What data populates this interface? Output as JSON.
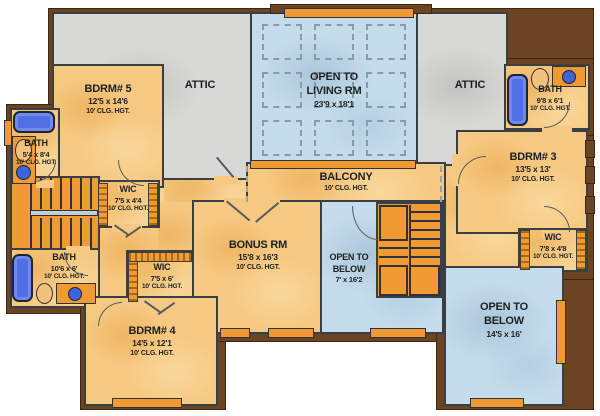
{
  "colors": {
    "interior_wall": "#3a3f44",
    "exterior_wall_brown": "#6b4423",
    "room_tan": "#f6c982",
    "attic_gray": "#d8d8d6",
    "open_area_blue": "#c4dceb",
    "stair_orange": "#ef9a33",
    "fixture_blue": "#4f6fe3",
    "label_text": "#1d2023"
  },
  "rooms": {
    "attic_left": {
      "name": "ATTIC"
    },
    "attic_right": {
      "name": "ATTIC"
    },
    "open_living": {
      "name1": "OPEN TO",
      "name2": "LIVING RM",
      "dims": "23'9 x 18'1"
    },
    "bdrm5": {
      "name": "BDRM# 5",
      "dims": "12'5 x 14'6",
      "clg": "10' CLG. HGT."
    },
    "bath_left": {
      "name": "BATH",
      "dims": "5'4 x 8'4",
      "clg": "10' CLG. HGT."
    },
    "wic1": {
      "name": "WIC",
      "dims": "7'5 x 4'4",
      "clg": "10' CLG. HGT."
    },
    "balcony": {
      "name": "BALCONY",
      "clg": "10' CLG. HGT."
    },
    "bath_tr": {
      "name": "BATH",
      "dims": "9'8 x 6'1",
      "clg": "10' CLG. HGT."
    },
    "bdrm3": {
      "name": "BDRM# 3",
      "dims": "13'5 x 13'",
      "clg": "10' CLG. HGT."
    },
    "bonus": {
      "name": "BONUS RM",
      "dims": "15'8 x 16'3",
      "clg": "10' CLG. HGT."
    },
    "open_below_c": {
      "name1": "OPEN TO",
      "name2": "BELOW",
      "dims": "7' x 16'2"
    },
    "wic_r": {
      "name": "WIC",
      "dims": "7'8 x 4'8",
      "clg": "10' CLG. HGT."
    },
    "bath_bl": {
      "name": "BATH",
      "dims": "10'6 x 6'",
      "clg": "10' CLG. HGT."
    },
    "wic2": {
      "name": "WIC",
      "dims": "7'5 x 6'",
      "clg": "10' CLG. HGT."
    },
    "bdrm4": {
      "name": "BDRM# 4",
      "dims": "14'5 x 12'1",
      "clg": "10' CLG. HGT."
    },
    "open_below_r": {
      "name1": "OPEN TO",
      "name2": "BELOW",
      "dims": "14'5 x 16'"
    }
  }
}
